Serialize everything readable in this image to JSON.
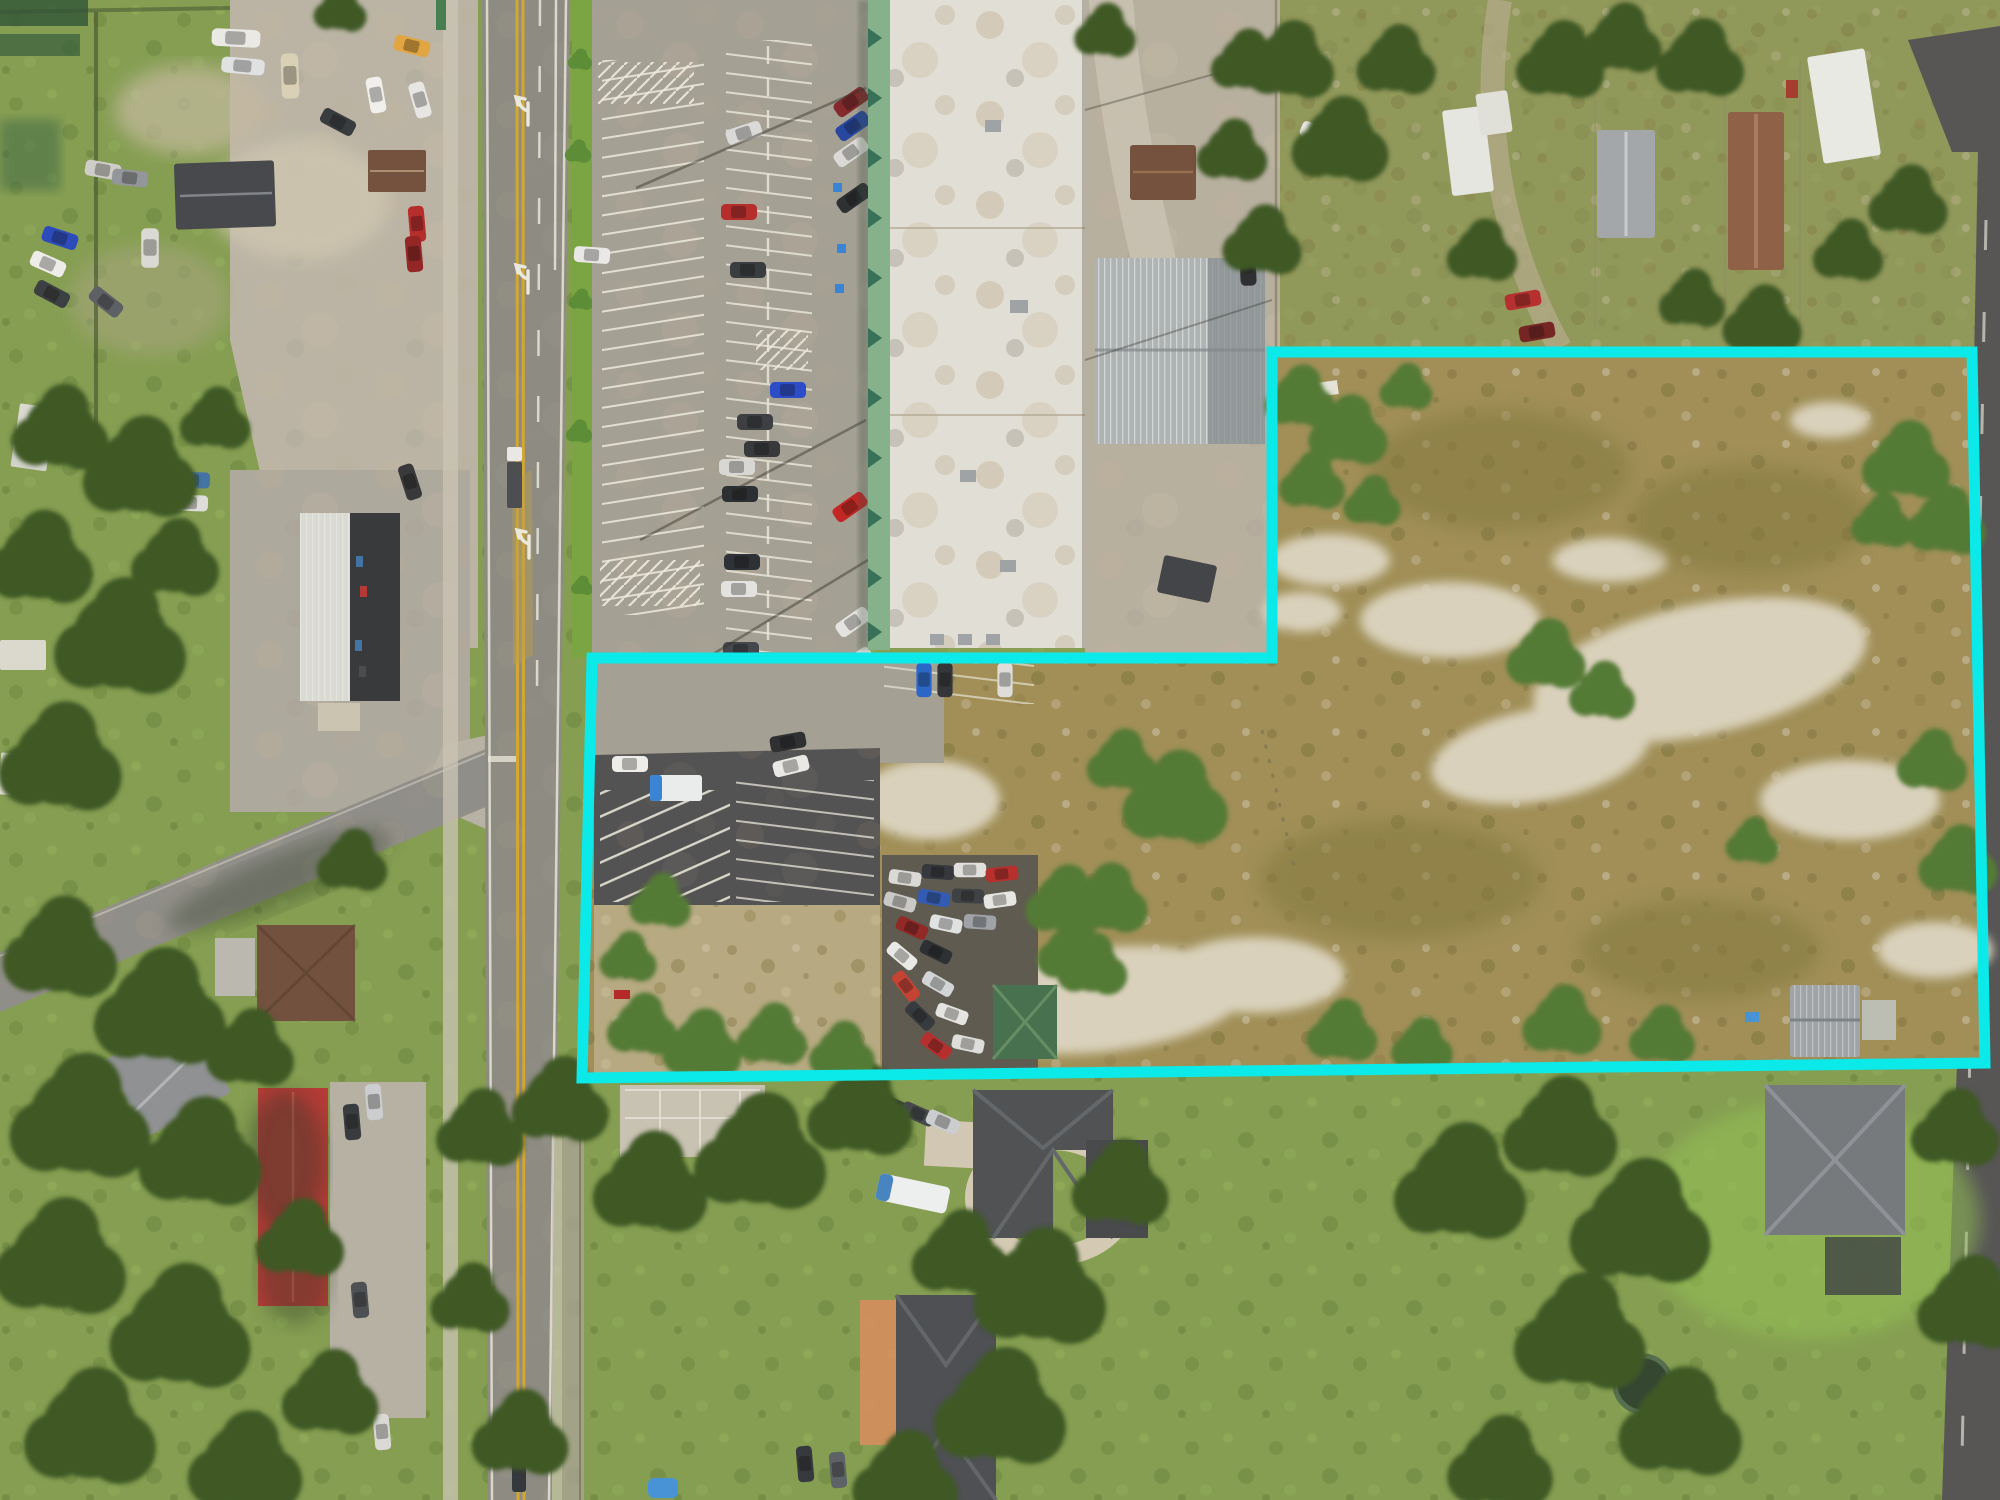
{
  "image": {
    "type": "aerial-drone-photograph",
    "subject": "Commercial land listing aerial with highlighted parcel boundary",
    "width_px": 2000,
    "height_px": 1500,
    "text_visible": "none"
  },
  "overlay": {
    "name": "property-boundary",
    "shape": "stair-step polygon",
    "color": "#0BE9E9",
    "stroke_width": 11,
    "points": "1272,352 1972,352 1985,1063 582,1078 592,658 1272,658"
  },
  "palette": {
    "boundary_cyan": "#0BE9E9",
    "road_asphalt": "#87867f",
    "parking_asphalt": "#a19c92",
    "fresh_asphalt": "#4b4b4d",
    "concrete": "#c6c0b2",
    "white_roof": "#e0ded6",
    "metal_roof": "#aab0b3",
    "green_awning": "#7fae88",
    "field_scrub": "#9c8b52",
    "sand": "#d8d0bc",
    "grass": "#7f9a4c",
    "tree_dark": "#35511f",
    "lane_yellow": "#d2a42a",
    "red_roof": "#b23230",
    "brown_roof": "#6e4a36",
    "dark_roof": "#45484d"
  },
  "scene": {
    "regions": [
      {
        "name": "highway",
        "description": "two-lane highway with double yellow centerline, turn arrows and turn lane running vertically on the left"
      },
      {
        "name": "shopping-center",
        "description": "white flat-roof retail strip with green sawtooth awning and striped parking lot, top center"
      },
      {
        "name": "vacant-parcel",
        "description": "brown scrub field with sand patches and shrubs inside the cyan boundary, right side"
      },
      {
        "name": "junk-car-lot",
        "description": "cluster of packed vehicles and a green-roof shed inside the boundary, center"
      },
      {
        "name": "junkyard",
        "description": "vehicle storage yard with sheds, top left"
      },
      {
        "name": "mobile-home-park",
        "description": "trailers and trees above the parcel, top right"
      },
      {
        "name": "residences",
        "description": "houses, lawns, driveways and large trees across the bottom"
      }
    ]
  }
}
